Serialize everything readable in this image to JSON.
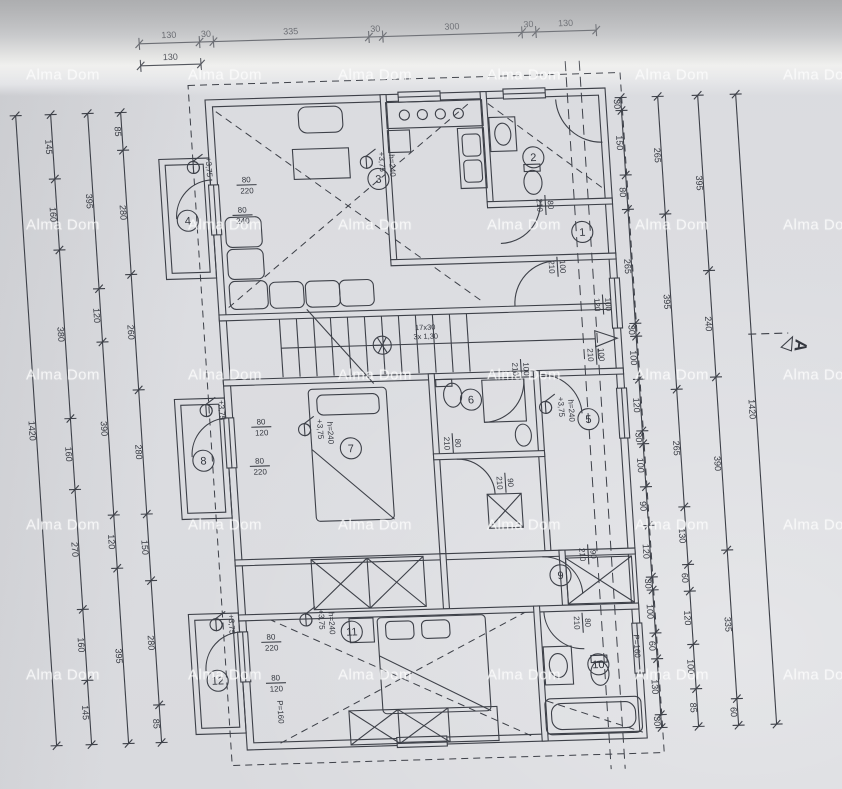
{
  "colors": {
    "paper": "#dcdde1",
    "ink": "#3d4048",
    "watermark_color": "rgba(253,253,253,0.78)"
  },
  "watermark": {
    "text": "Alma Dom",
    "columns_x": [
      63,
      225,
      375,
      524,
      672,
      820
    ],
    "rows_y": [
      75,
      225,
      375,
      525,
      675
    ]
  },
  "plan": {
    "dims": {
      "left": [
        {
          "x": -190,
          "vals": [
            "1420"
          ]
        },
        {
          "x": -155,
          "vals": [
            "145",
            "160",
            "380",
            "160",
            "270",
            "160",
            "145"
          ]
        },
        {
          "x": -118,
          "vals": [
            "395",
            "120",
            "390",
            "120",
            "395"
          ]
        },
        {
          "x": -85,
          "vals": [
            "85",
            "280",
            "260",
            "280",
            "150",
            "280",
            "85"
          ]
        }
      ],
      "right": [
        {
          "x": 415,
          "vals": [
            "30",
            "150",
            "80",
            "265",
            "30",
            "100",
            "120",
            "30",
            "100",
            "90",
            "120",
            "30",
            "100",
            "60",
            "130",
            "30"
          ]
        },
        {
          "x": 452,
          "vals": [
            "265",
            "395",
            "265",
            "130",
            "60",
            "120",
            "100",
            "85"
          ]
        },
        {
          "x": 492,
          "vals": [
            "395",
            "240",
            "390",
            "335",
            "60"
          ]
        },
        {
          "x": 530,
          "vals": [
            "1420"
          ]
        }
      ],
      "top": [
        {
          "y": -58,
          "vals": [
            "130",
            "30",
            "335",
            "30",
            "300",
            "30",
            "130"
          ]
        },
        {
          "y": -36,
          "vals": [
            "130"
          ]
        }
      ]
    },
    "rooms": [
      {
        "n": "1",
        "x": 368,
        "y": 143
      },
      {
        "n": "2",
        "x": 324,
        "y": 67
      },
      {
        "n": "3",
        "x": 168,
        "y": 84
      },
      {
        "n": "4",
        "x": -25,
        "y": 120
      },
      {
        "n": "5",
        "x": 362,
        "y": 330
      },
      {
        "n": "6",
        "x": 246,
        "y": 307
      },
      {
        "n": "7",
        "x": 123,
        "y": 352
      },
      {
        "n": "8",
        "x": -25,
        "y": 360
      },
      {
        "n": "9",
        "x": 324,
        "y": 485
      },
      {
        "n": "10",
        "x": 356,
        "y": 575
      },
      {
        "n": "11",
        "x": 112,
        "y": 535
      },
      {
        "n": "12",
        "x": -25,
        "y": 580
      }
    ],
    "openings": [
      {
        "x": 36,
        "y": 86,
        "w": "80",
        "h": "220",
        "a": 0
      },
      {
        "x": 30,
        "y": 116,
        "w": "80",
        "h": "240",
        "a": 0
      },
      {
        "x": 341,
        "y": 177,
        "w": "100",
        "h": "210",
        "a": 90
      },
      {
        "x": 384,
        "y": 216,
        "w": "100",
        "h": "120",
        "a": 90
      },
      {
        "x": 374,
        "y": 266,
        "w": "100",
        "h": "210",
        "a": 90
      },
      {
        "x": 225,
        "y": 350,
        "w": "80",
        "h": "210",
        "a": 90
      },
      {
        "x": 35,
        "y": 328,
        "w": "80",
        "h": "120",
        "a": 0
      },
      {
        "x": 31,
        "y": 367,
        "w": "80",
        "h": "220",
        "a": 0
      },
      {
        "x": 31,
        "y": 543,
        "w": "80",
        "h": "220",
        "a": 0
      },
      {
        "x": 33,
        "y": 584,
        "w": "80",
        "h": "120",
        "a": 0
      },
      {
        "x": 353,
        "y": 465,
        "w": "90",
        "h": "210",
        "a": 90
      },
      {
        "x": 275,
        "y": 391,
        "w": "90",
        "h": "210",
        "a": 90
      },
      {
        "x": 343,
        "y": 533,
        "w": "80",
        "h": "210",
        "a": 90
      },
      {
        "x": 333,
        "y": 115,
        "w": "80",
        "h": "210",
        "a": 90
      },
      {
        "x": 298,
        "y": 278,
        "w": "100",
        "h": "210",
        "a": 90
      }
    ],
    "levels": [
      {
        "x": -16,
        "y": 67,
        "t": "+3,75",
        "s": ""
      },
      {
        "x": 157,
        "y": 67,
        "t": "+3,75",
        "s": "h=240"
      },
      {
        "x": -19,
        "y": 310,
        "t": "+3,75",
        "s": ""
      },
      {
        "x": 78,
        "y": 332,
        "t": "+3,75",
        "s": "h=240"
      },
      {
        "x": 320,
        "y": 317,
        "t": "+3,75",
        "s": "h=240"
      },
      {
        "x": 67,
        "y": 522,
        "t": "+3,75",
        "s": "h=240"
      },
      {
        "x": -23,
        "y": 524,
        "t": "+3,75",
        "s": ""
      }
    ],
    "parapets": [
      {
        "x": 393,
        "y": 558,
        "t": "P=160"
      },
      {
        "x": 33,
        "y": 613,
        "t": "P=160"
      }
    ],
    "stairs": {
      "line1": "17x30",
      "line2": "3x 1,30",
      "x": 205,
      "y": 236
    },
    "section": {
      "label": "A",
      "x": 573,
      "y": 262
    }
  }
}
